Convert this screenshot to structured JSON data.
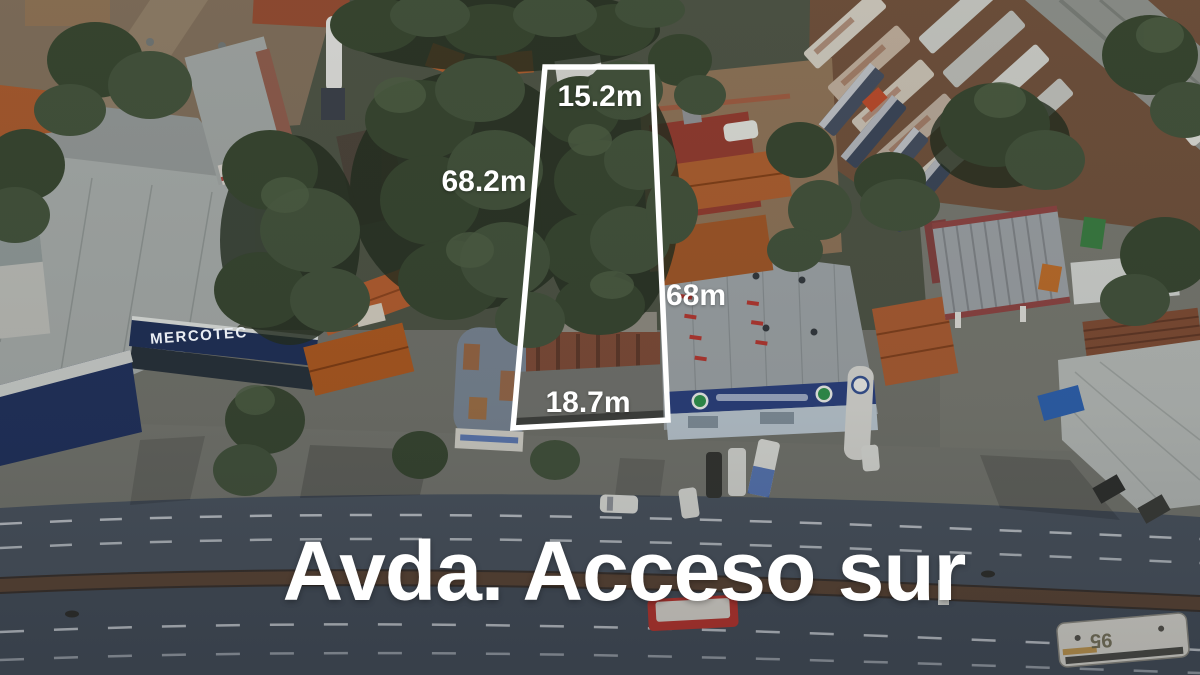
{
  "annotations": {
    "top_label": "15.2m",
    "left_label": "68.2m",
    "right_label": "68m",
    "bottom_label": "18.7m"
  },
  "street": {
    "name_label": "Avda. Acceso sur"
  },
  "scene": {
    "store_sign": "MERCOTEC",
    "bus_number": "95"
  },
  "colors": {
    "boundary_outline": "#ffffff",
    "label_text": "#ffffff"
  }
}
